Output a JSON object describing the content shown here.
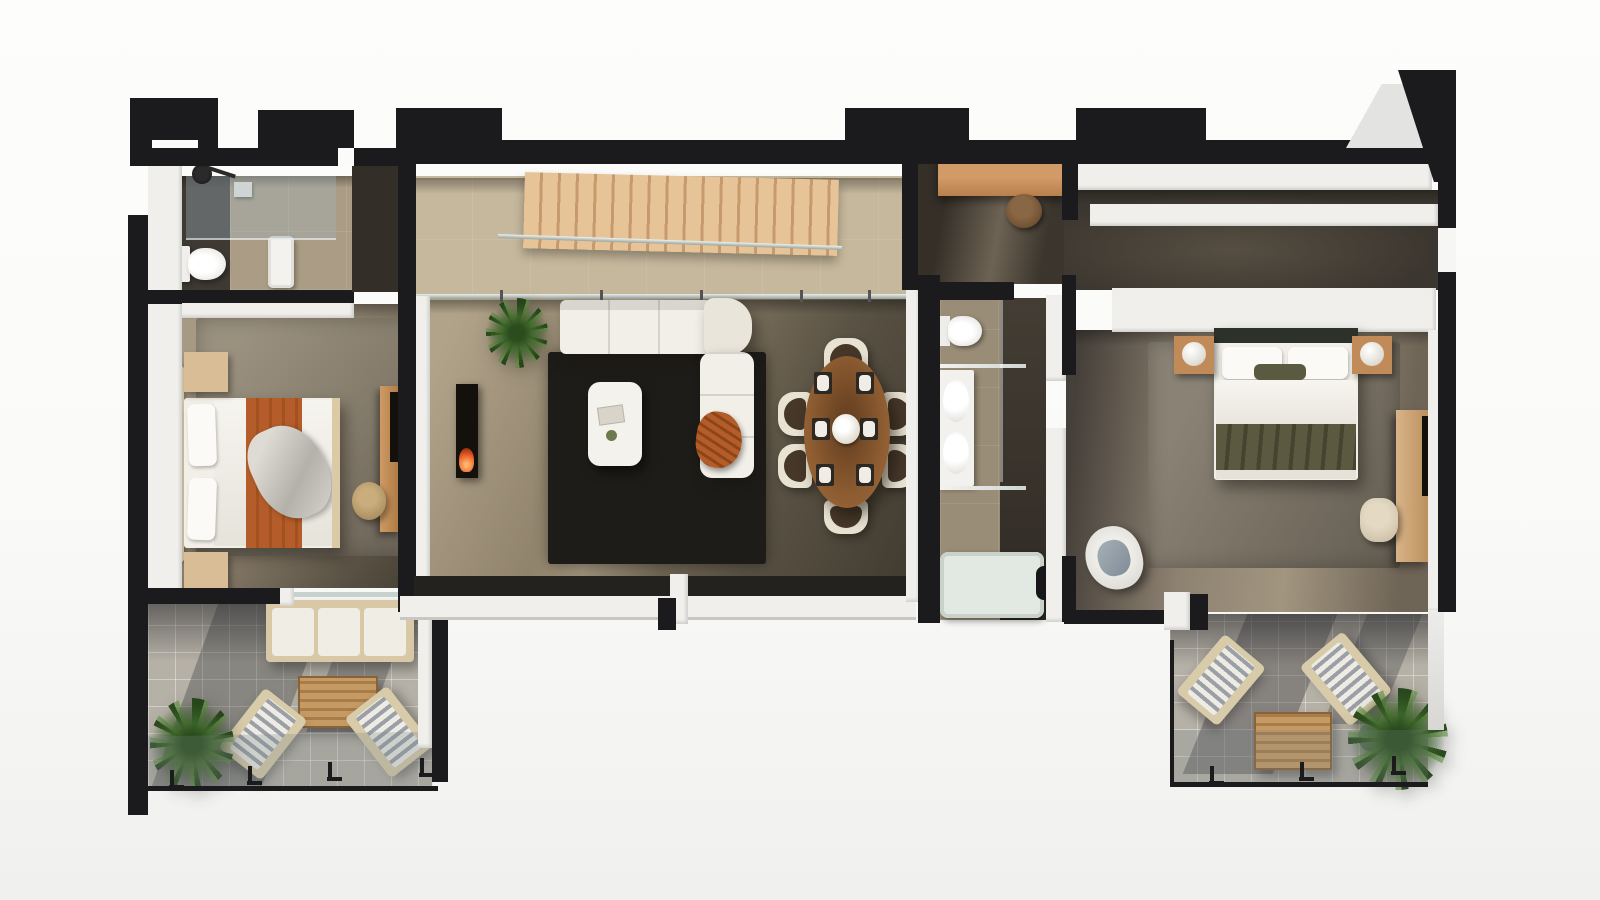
{
  "meta": {
    "kind": "3d-floor-plan-render",
    "view": "top-down cut-away (dollhouse)",
    "text_on_screen": "none",
    "background": "plain white studio backdrop"
  },
  "palette": {
    "bg": "#fafaf8",
    "wall": "#1b1b1d",
    "wall-white": "#f0efeb",
    "wall-shadow": "#cfccc6",
    "floor-beige": "#ab9d85",
    "floor-beige-light": "#c6b89d",
    "floor-olive": "#6e6554",
    "floor-dark": "#46403a",
    "floor-charcoal": "#3b362f",
    "terrace-tile": "#b6b1a7",
    "rug-gray": "#8e877b",
    "rug-dark": "#211f1c",
    "wood-stair": "#dcb88c",
    "wood-stair-dark": "#c2936a",
    "wood-light": "#d9bd96",
    "wood-mid": "#c08b58",
    "wood-table": "#8d5c31",
    "linen": "#f2efe8",
    "orange": "#b45d2b",
    "olive": "#5b5940",
    "green": "#44702e",
    "green-dark": "#2b4d1d",
    "glass-line": "#c7d2ce",
    "tub": "#e2e9e2",
    "tv": "#14110c",
    "flame": "#e65a24",
    "chair-shell": "#e8e2d2",
    "seat-brown": "#463729",
    "stool-tan": "#b1925f",
    "charcoal-strip": "#332e28"
  },
  "rooms": [
    {
      "id": "bathroom-1",
      "type": "bathroom",
      "location": "top-left",
      "fixtures": [
        "walk-in shower with glass screen",
        "black rain shower head",
        "toilet",
        "white washbasin",
        "shower shelf"
      ]
    },
    {
      "id": "bedroom-1",
      "type": "bedroom",
      "location": "left",
      "furniture": [
        "double bed, white linen with rust-orange throw and patterned blanket",
        "light-wood headboard bench",
        "2 wooden nightstands",
        "large grey area rug",
        "wooden console",
        "wall-mounted TV panel",
        "round tan pouf"
      ]
    },
    {
      "id": "terrace-1",
      "type": "terrace",
      "location": "bottom-left",
      "furniture": [
        "outdoor 3-seat sofa",
        "slatted wooden coffee table",
        "2 sun loungers with grey striped cushions",
        "potted palm"
      ],
      "enclosure": "glass railing with black L-posts"
    },
    {
      "id": "stair-hall",
      "type": "hall",
      "location": "top-center",
      "features": [
        "straight wooden staircase of ~20 treads",
        "glass balustrade",
        "beige stone tile floor"
      ]
    },
    {
      "id": "living-room",
      "type": "living room",
      "location": "center",
      "furniture": [
        "cream sectional sofa with round chaise",
        "cream two-seat sofa",
        "rust woven throw",
        "near-black area rug",
        "white oval coffee table with books and bowl",
        "fireplace with burning flame",
        "potted palm"
      ],
      "boundary": "full-width glazing to the south with white sill and black mullion"
    },
    {
      "id": "dining-area",
      "type": "dining",
      "location": "center-right",
      "furniture": [
        "oval walnut dining table",
        "6 chairs with cream shells and dark brown cushions",
        "6 place settings",
        "white flower centerpiece"
      ]
    },
    {
      "id": "hallway",
      "type": "hall",
      "location": "right-of-living",
      "furniture": [
        "built-in wooden desk / dressing counter",
        "round wooden stool"
      ]
    },
    {
      "id": "bathroom-2",
      "type": "bathroom",
      "location": "middle-right",
      "fixtures": [
        "toilet",
        "white double-basin vanity",
        "2 glass shelves",
        "bathtub with black floor-mounted tap",
        "dark tiled shower zone"
      ]
    },
    {
      "id": "walk-in-closet",
      "type": "closet",
      "location": "top-right",
      "features": [
        "two long white wardrobe runs",
        "open white shelf band",
        "dark charcoal floor"
      ]
    },
    {
      "id": "bedroom-2",
      "type": "bedroom",
      "location": "right",
      "furniture": [
        "double bed, white linen with olive-green throw",
        "dark slim headboard",
        "2 wooden nightstands with white globe lamps",
        "grey area rug",
        "wooden media console",
        "wall-mounted TV panel",
        "cream stool",
        "grey-blue swivel armchair"
      ]
    },
    {
      "id": "terrace-2",
      "type": "terrace",
      "location": "bottom-right",
      "furniture": [
        "2 angled sun loungers",
        "slatted wooden cube table",
        "palm in round grey planter"
      ],
      "enclosure": "glass railing with black posts"
    }
  ],
  "counts": {
    "bedrooms": 2,
    "bathrooms": 2,
    "terraces": 2,
    "dining_seats": 6,
    "stair_treads": 20,
    "sun_loungers": 4,
    "potted_palms": 3
  }
}
